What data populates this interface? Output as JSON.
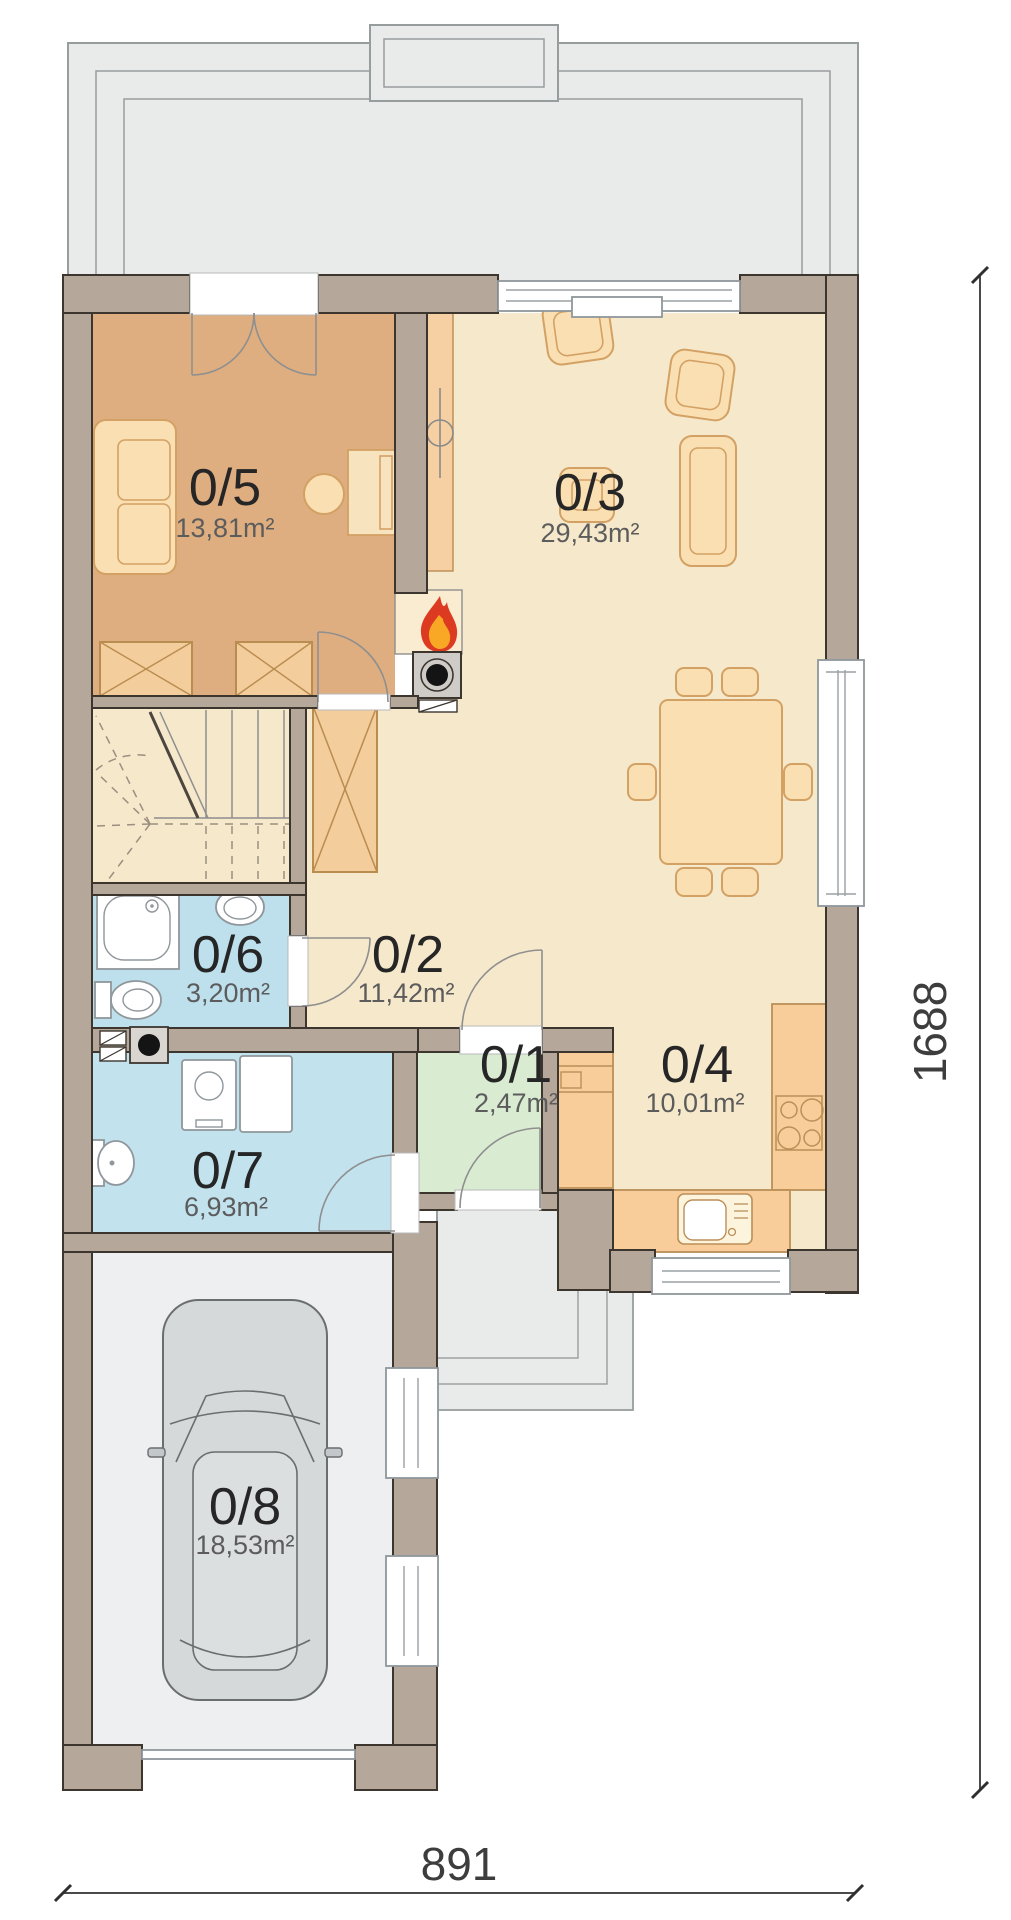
{
  "rooms": {
    "r1": {
      "label": "0/1",
      "area": "2,47m²"
    },
    "r2": {
      "label": "0/2",
      "area": "11,42m²"
    },
    "r3": {
      "label": "0/3",
      "area": "29,43m²"
    },
    "r4": {
      "label": "0/4",
      "area": "10,01m²"
    },
    "r5": {
      "label": "0/5",
      "area": "13,81m²"
    },
    "r6": {
      "label": "0/6",
      "area": "3,20m²"
    },
    "r7": {
      "label": "0/7",
      "area": "6,93m²"
    },
    "r8": {
      "label": "0/8",
      "area": "18,53m²"
    }
  },
  "dimensions": {
    "width": "891",
    "height": "1688"
  },
  "colors": {
    "wall": "#b5a79a",
    "room_0_5": "#deae80",
    "room_living": "#f6e8cb",
    "room_bath": "#bee0ec",
    "room_utility": "#c2e2ee",
    "room_vestibule": "#d9ecd2",
    "room_garage": "#edeff0",
    "terrace": "#e9ebeb",
    "counter": "#f8cd99",
    "closet": "#f3cd9b",
    "flame_red": "#dd3a22",
    "flame_orange": "#f9a825"
  },
  "icons": {
    "fireplace": "flame-icon",
    "car": "car-top-view-icon",
    "chimney": "chimney-flue-icon",
    "vent": "vent-flue-icon"
  }
}
